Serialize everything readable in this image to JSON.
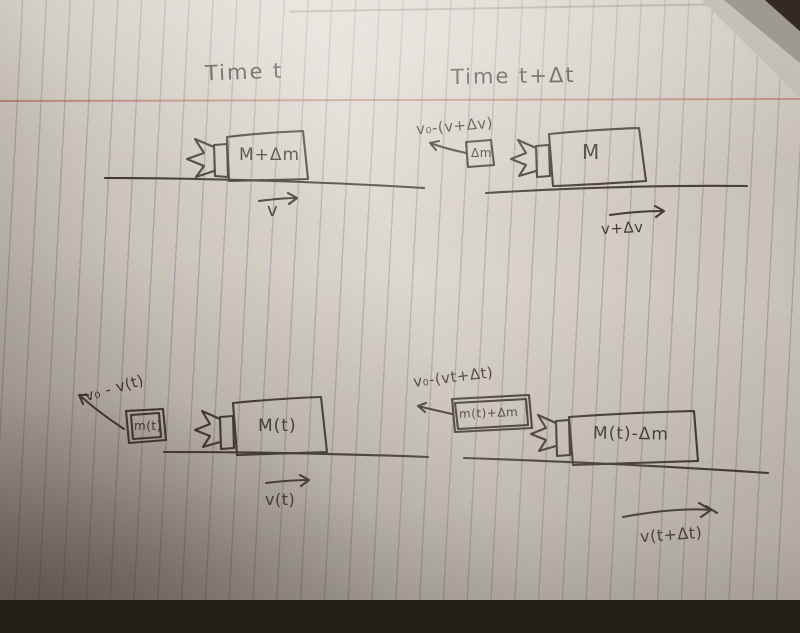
{
  "photo": {
    "headers": {
      "time_t": "Time t",
      "time_t_dt": "Time t+Δt"
    },
    "top_left": {
      "box_label": "M+Δm",
      "velocity_label": "v"
    },
    "top_right": {
      "ejecta_velocity_label": "v₀-(v+Δv)",
      "ejecta_box_label": "Δm",
      "box_label": "M",
      "velocity_label": "v+Δv"
    },
    "bottom_left": {
      "ejecta_velocity_label": "v₀ - v(t)",
      "ejecta_box_label": "m(t)",
      "box_label": "M(t)",
      "velocity_label": "v(t)"
    },
    "bottom_right": {
      "ejecta_velocity_label": "v₀-(vt+Δt)",
      "ejecta_box_label": "m(t)+Δm",
      "box_label": "M(t)-Δm",
      "velocity_label": "v(t+Δt)"
    },
    "colors": {
      "ink": "#3a342c",
      "ruled_line": "#6e7d96",
      "margin_line": "#b05a48",
      "paper": "#d8d2c9",
      "background": "#241e18",
      "under_sheet": "#a9a49d"
    }
  }
}
